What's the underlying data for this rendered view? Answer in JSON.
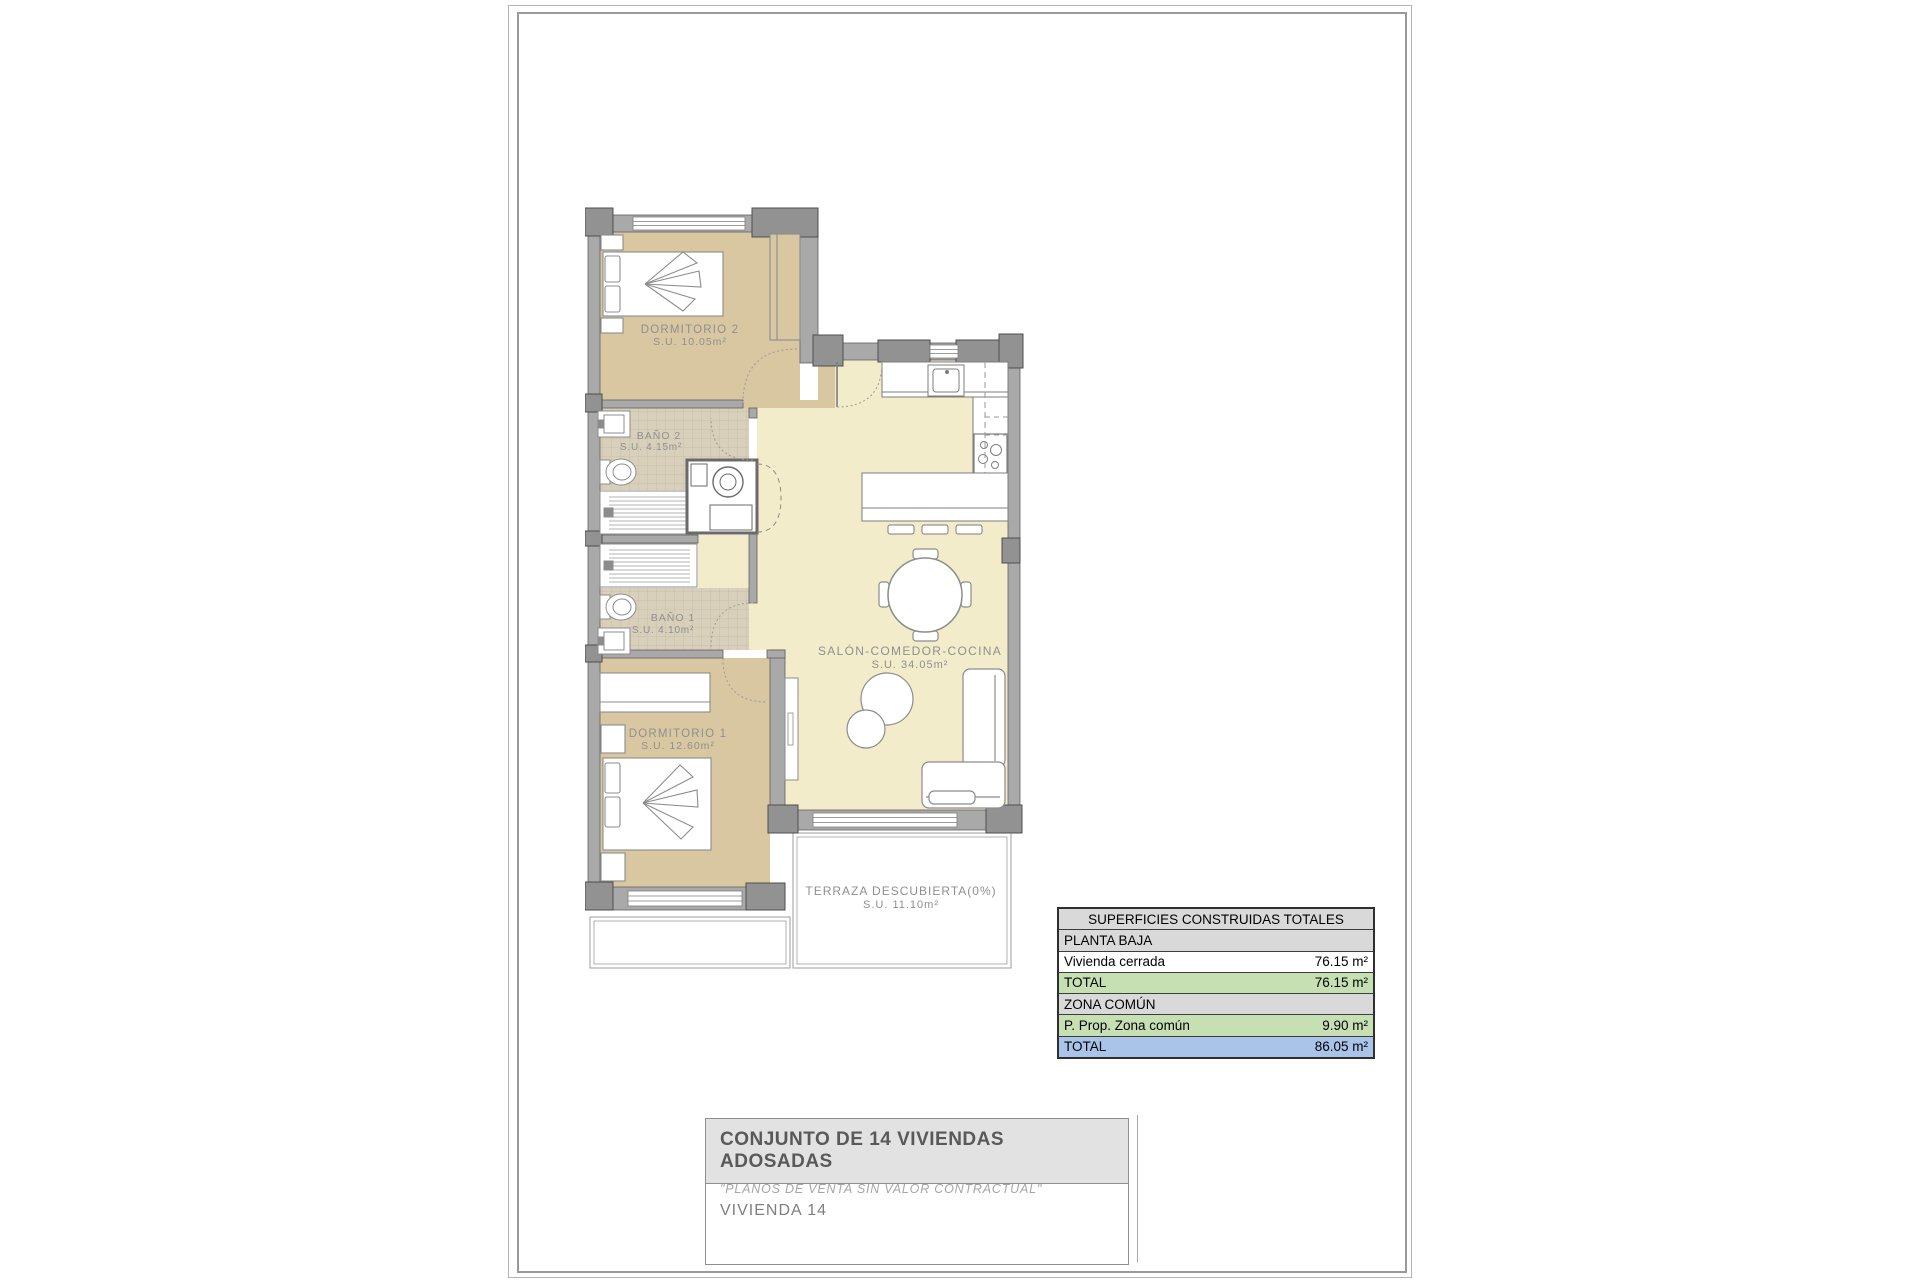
{
  "plan": {
    "rooms": [
      {
        "name": "DORMITORIO 2",
        "area": "S.U. 10.05m²"
      },
      {
        "name": "BAÑO 2",
        "area": "S.U. 4.15m²"
      },
      {
        "name": "BAÑO 1",
        "area": "S.U. 4.10m²"
      },
      {
        "name": "DORMITORIO 1",
        "area": "S.U. 12.60m²"
      },
      {
        "name": "SALÓN-COMEDOR-COCINA",
        "area": "S.U. 34.05m²"
      },
      {
        "name": "TERRAZA DESCUBIERTA(0%)",
        "area": "S.U. 11.10m²"
      }
    ],
    "colors": {
      "bedroom_floor": "#d9c7a1",
      "living_floor": "#f2ecca",
      "bath_tile": "#d8d0ba",
      "wall": "#a9a9a9",
      "pillar": "#929292",
      "label_text": "#8f8f8f"
    }
  },
  "areas_table": {
    "title": "SUPERFICIES CONSTRUIDAS TOTALES",
    "rows": [
      {
        "label": "PLANTA BAJA",
        "value": ""
      },
      {
        "label": "Vivienda cerrada",
        "value": "76.15 m²"
      },
      {
        "label": "TOTAL",
        "value": "76.15 m²"
      },
      {
        "label": "ZONA COMÚN",
        "value": ""
      },
      {
        "label": "P. Prop. Zona común",
        "value": "9.90 m²"
      },
      {
        "label": "TOTAL",
        "value": "86.05 m²"
      }
    ],
    "colors": {
      "section": "#d9d9d9",
      "subtotal_green": "#c6e0b4",
      "total_blue": "#a9c4e8"
    }
  },
  "title_block": {
    "project": "CONJUNTO DE 14 VIVIENDAS ADOSADAS",
    "disclaimer": "\"PLANOS DE VENTA SIN VALOR CONTRACTUAL\"",
    "unit": "VIVIENDA 14"
  }
}
